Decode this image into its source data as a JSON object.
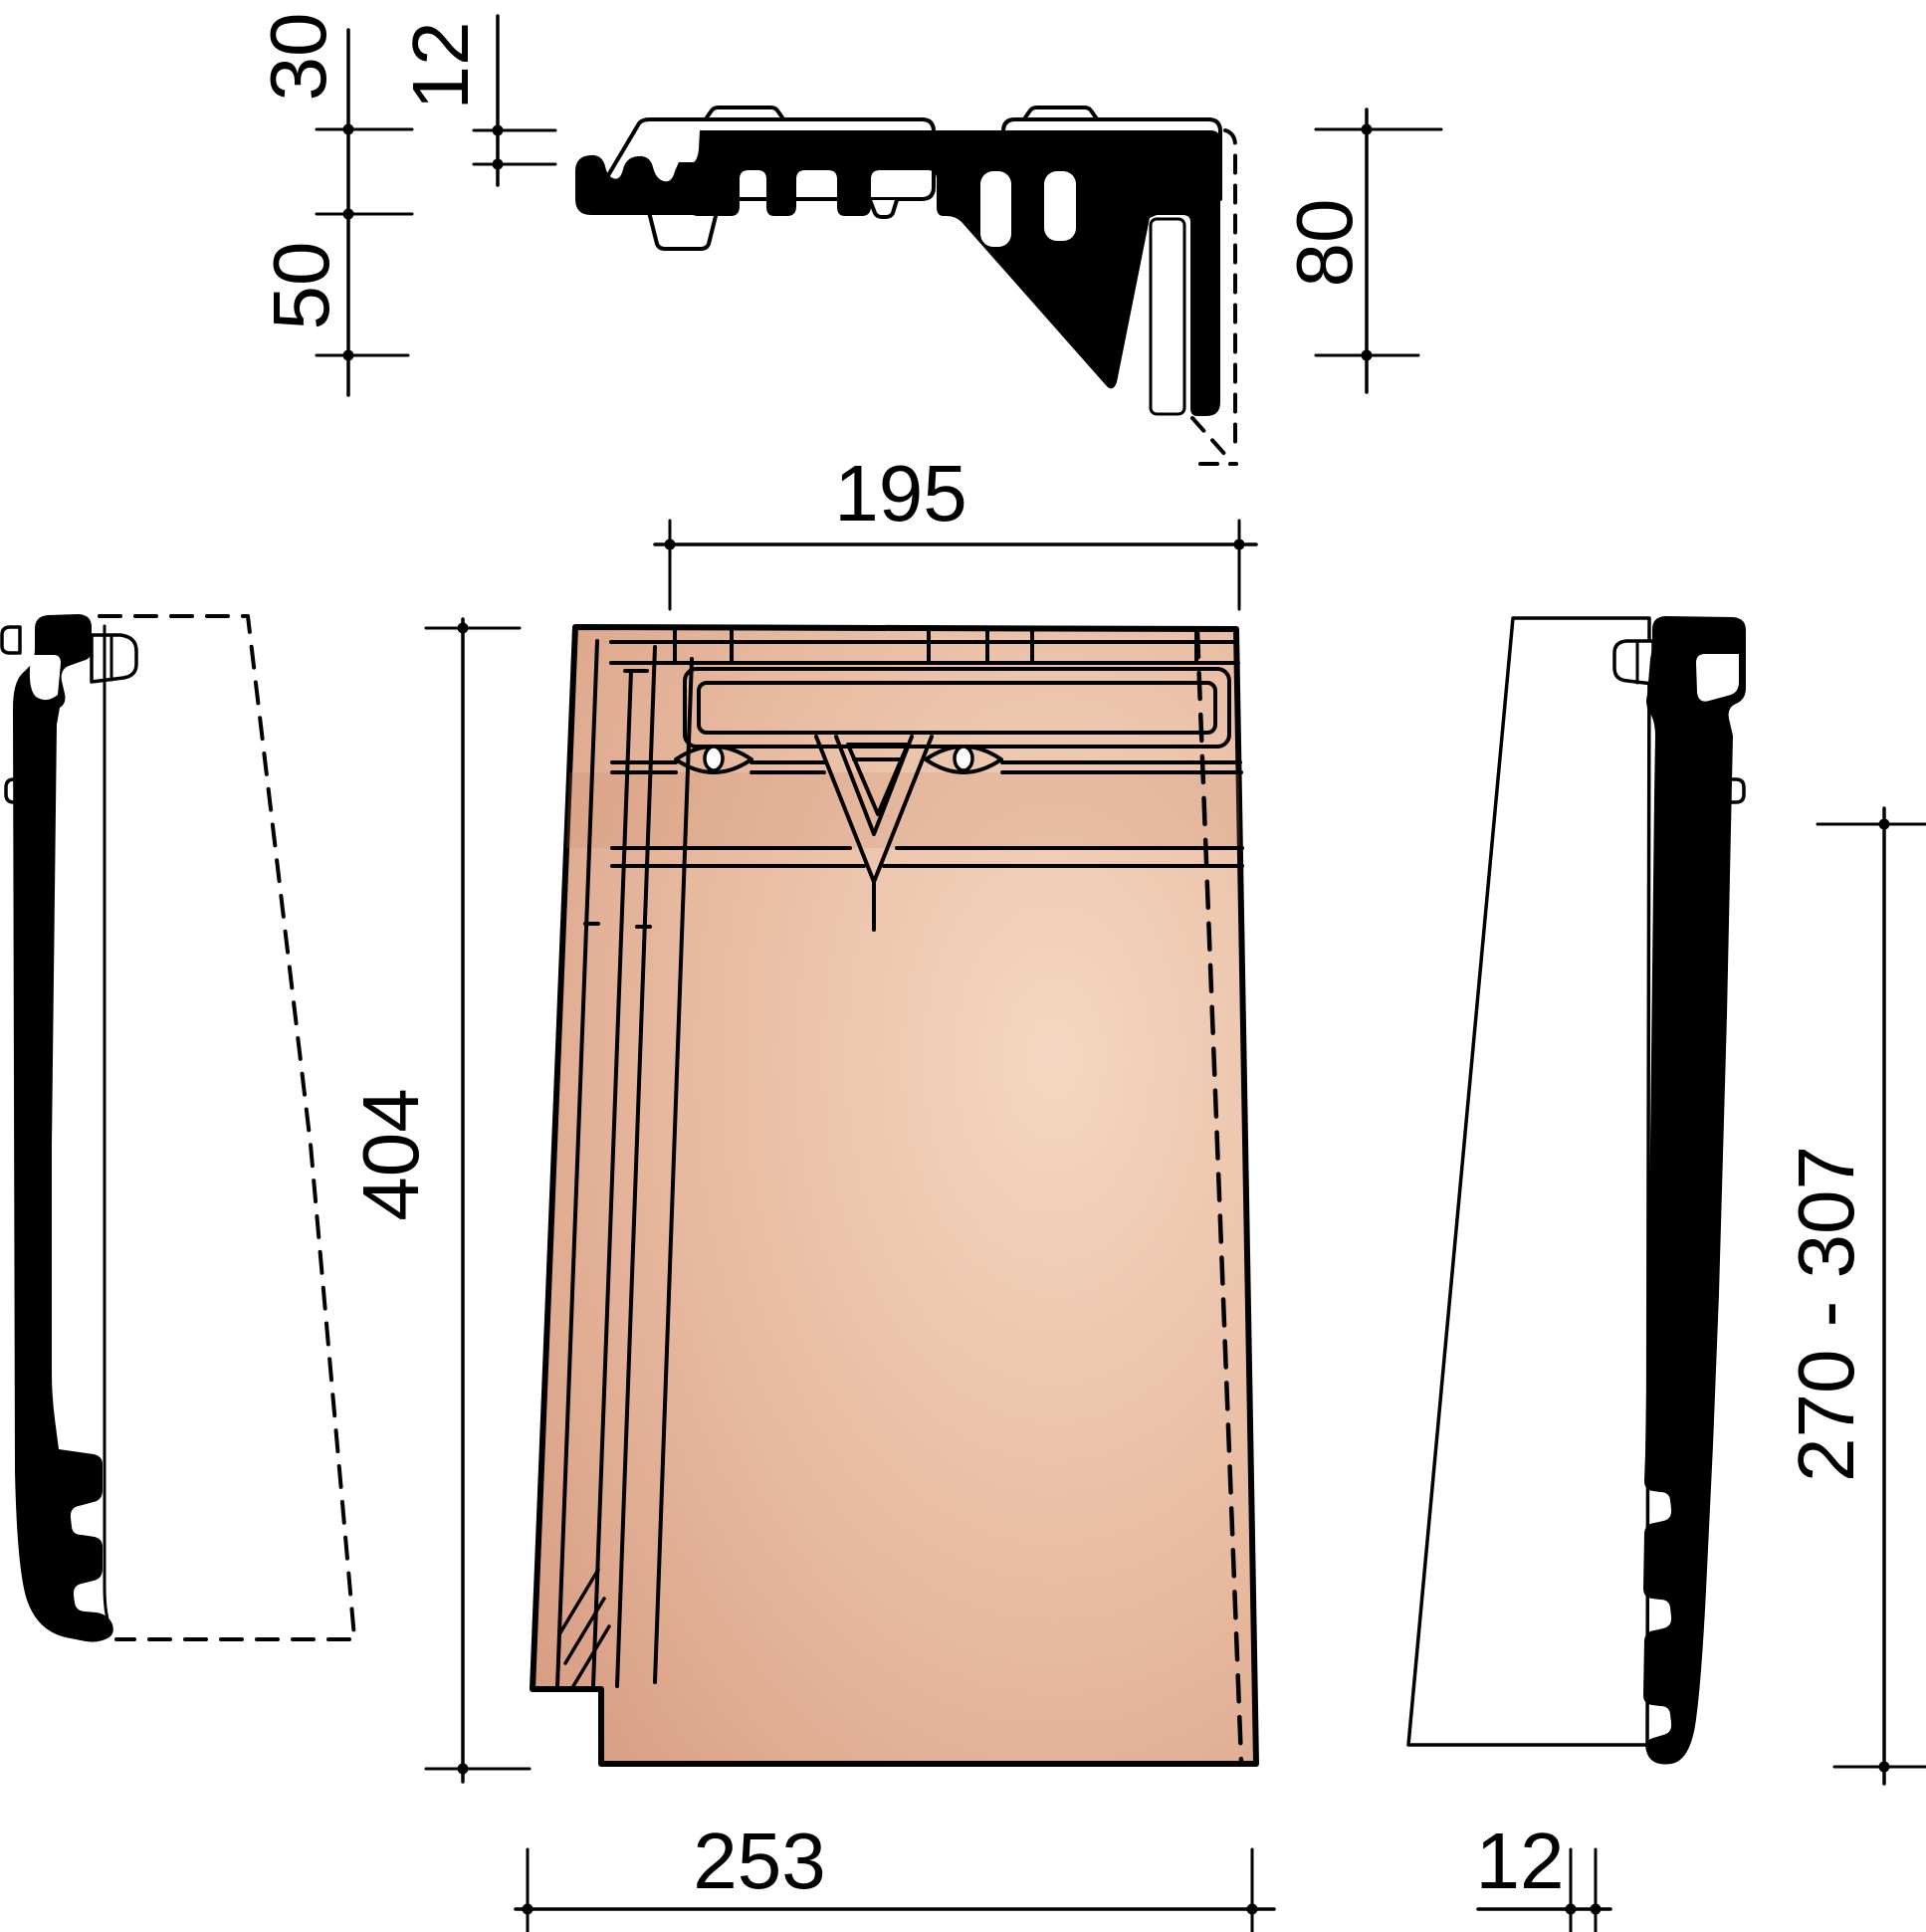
{
  "colors": {
    "ink": "#000000",
    "paper": "#ffffff",
    "tile_light": "#f4d7c2",
    "tile_mid": "#e7b99f",
    "tile_dark": "#d2947a",
    "tile_shadow": "#c9825f"
  },
  "dimensions": {
    "section": {
      "channel_depth": "30",
      "overlap": "12",
      "side_height": "50",
      "total_height": "80"
    },
    "plan": {
      "head_width": "195",
      "length": "404",
      "bottom_width": "253"
    },
    "side": {
      "hang_range": "270 - 307",
      "edge_thickness": "12"
    }
  }
}
